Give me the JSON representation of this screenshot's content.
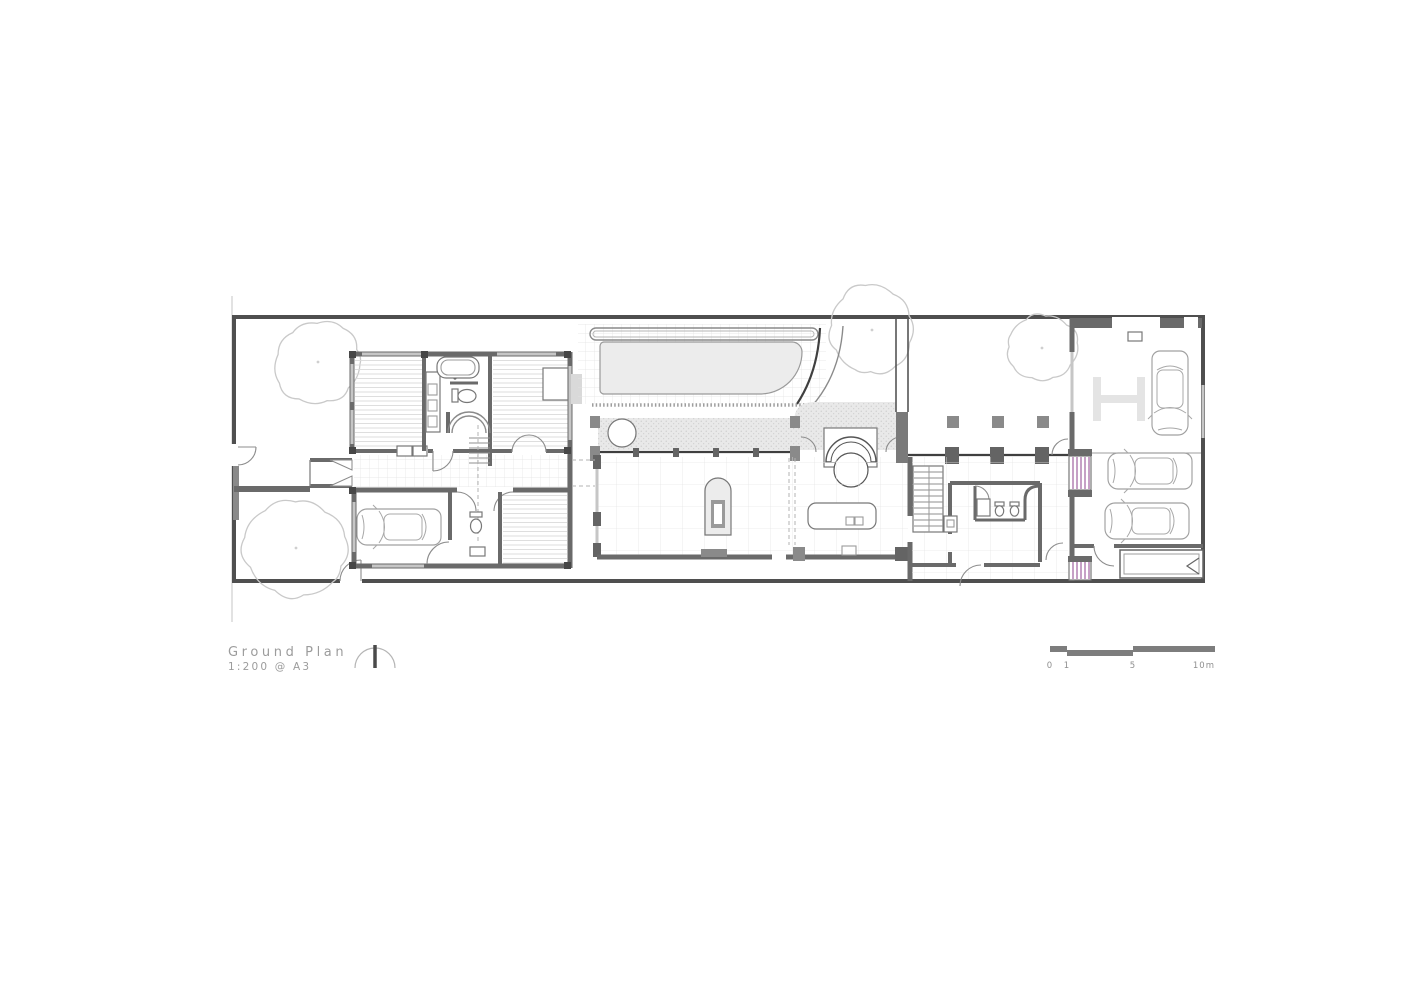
{
  "title_block": {
    "title": "Ground Plan",
    "scale_note": "1:200 @ A3"
  },
  "scale_bar": {
    "labels": [
      "0",
      "1",
      "5",
      "10m"
    ]
  },
  "north_arrow": {
    "present": true,
    "style": "half-circle-with-needle"
  },
  "colors": {
    "wall": "#6a6a6a",
    "wall_dark": "#474747",
    "site_boundary": "#4f4f4f",
    "window": "#c6c6c6",
    "stair_accent": "#a86ca8",
    "pool_fill": "#ececec",
    "planter_fill": "#e9e9e9",
    "tree_line": "#c9c9c9",
    "annotation_text": "#9c9c9c",
    "scale_bar": "#7d7d7d"
  },
  "features": [
    "site-boundary",
    "front-yard-trees",
    "entry-gate",
    "bedroom",
    "bathroom-tub",
    "wardrobe-vanity",
    "main-stair",
    "entry-porch",
    "hallway",
    "garage-left",
    "car-in-garage",
    "powder-room",
    "study-room",
    "pool",
    "pool-bench",
    "planter-strip",
    "arched-water-feature",
    "fireplace-niche",
    "living-area",
    "kitchen-island",
    "courtyard",
    "columns",
    "service-rooms",
    "wc-pair",
    "service-stair",
    "purple-stairs",
    "rear-garage",
    "car-lift-H-marking",
    "car-vertical",
    "car-horizontal-1",
    "car-horizontal-2",
    "roller-door",
    "north-arrow",
    "scale-bar"
  ]
}
